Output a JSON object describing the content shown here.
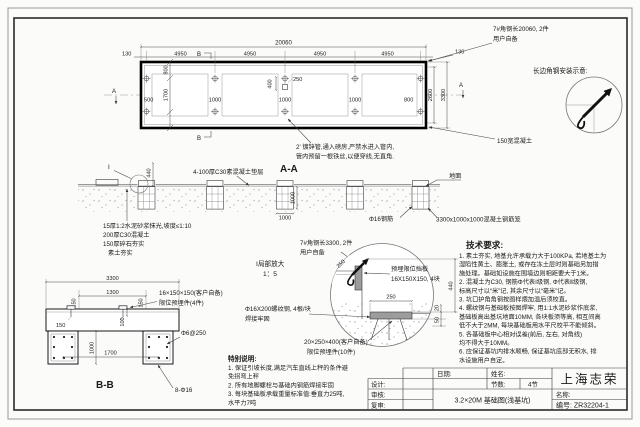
{
  "plan": {
    "dims": {
      "total": "20060",
      "seg": [
        "4950",
        "4950",
        "4950",
        "4950"
      ],
      "end_left": "130",
      "end_right": "130",
      "v800": "800",
      "v1700": "1700",
      "left_margin": "500",
      "gaps": [
        "1000",
        "1000",
        "1000"
      ],
      "right_margin": "800",
      "inner_width": "2600",
      "outer_width": "3300",
      "c250": "250",
      "c400": "400"
    },
    "marker_b_top": "B",
    "marker_b_bottom": "B",
    "marker_a_left": "A",
    "marker_a_right": "A",
    "note_pipe1": "2′ 镀锌管,通入磅房,严禁水进入管内,",
    "note_pipe2": "管内预留一根铁丝,以便穿线,无直角.",
    "angle_label1": "7#角钢长20060, 2件",
    "angle_label2": "用户自备",
    "edge_label": "150宽混凝土"
  },
  "corner": {
    "title": "长边角钢安装示意:"
  },
  "aa": {
    "title": "A-A",
    "cushion": "4-100厚C30素混凝土垫层",
    "detail_mark": "Ⅰ",
    "d440": "440",
    "d1000v": "1000",
    "d1000h": "1000",
    "ground": "地面",
    "layer1": "15厚1:2水泥砂浆抹光,坡度≤1:10",
    "layer2": "200厚C30混凝土",
    "layer3": "150厚碎石夯实",
    "layer4": "素土夯实",
    "rebar": "Φ16钢筋",
    "cage": "3300x1000x1000混凝土钢筋笼",
    "angle_label1": "7#角钢长3300, 2件",
    "angle_label2": "用户自备"
  },
  "detail": {
    "title1": "Ⅰ局部放大",
    "title2": "1：5",
    "plate1": "预埋限位挡板",
    "plate2": "16X150X150, 4块",
    "d250diag": "250",
    "d250": "250",
    "d440": "440",
    "d20": "20",
    "d50": "50",
    "bolt1": "Φ16X200螺纹钢, 4根/块",
    "bolt2": "焊接牢固",
    "stop1": "20×250×400(客户自备)",
    "stop2": "限位预埋件(10件)"
  },
  "bb": {
    "title": "B-B",
    "d3300": "3300",
    "d1300": "1300",
    "d150a": "150",
    "d150b": "150",
    "d150c": "150",
    "d100": "100",
    "d1000": "1000",
    "d1700": "1700",
    "embed1": "16×150×150(客户自备)",
    "embed2": "限位预埋件(4件)",
    "stirrup": "Φ6@250",
    "rebar": "8-Φ16"
  },
  "special": {
    "title": "特别说明:",
    "lines": [
      "1. 保证引坡长度,满足汽车直线上秤的条件避",
      "免拐弯上秤",
      "2. 所有地脚螺栓与基础内钢筋焊接牢固",
      "3. 每块基础板承载重量标准值:垂直力25吨,",
      "水平力7吨"
    ]
  },
  "tech": {
    "title": "技术要求:",
    "lines": [
      "1. 素土夯实, 地基允许承载力大于100KPa, 若地基土为",
      "湿陷性黄土、膨胀土, 或存在冻土层时则基础另加措",
      "施处理。基础如设施在围墙边则相距要大于1米。",
      "2. 混凝土为C30, 钢筋Φ代表Ⅰ级钢, Φ代表Ⅱ级钢,",
      "标高尺寸以“米”记, 其余尺寸以“毫米”记。",
      "3. 坑口护角角钢按图样煨加温后须校直。",
      "4. 螺纹钢与基础板按图焊牢, 用1:1水泥砂浆作底浆,",
      "基础板高出基坑地面10MM, 各块板须等高, 相互间高",
      "低不大于2MM, 每块基础板用水平尺校平不能倾斜。",
      "5. 各基础板中心相对误差(前后, 左右, 对角线)",
      "均不得大于10MM。",
      "6. 应保证基坑内排水顺畅, 保证基坑底部无积水, 排",
      "水设施用户自定。"
    ]
  },
  "tb": {
    "date": "日期:",
    "name": "姓名:",
    "sections": "节数:",
    "sections_val": "4节",
    "design": "设计:",
    "check": "审核:",
    "recheck": "复审:",
    "brand": "上海志荣",
    "title": "3.2×20M 基础图(浅基坑)",
    "name_label": "名称:",
    "number": "编号: ZR32204-1"
  }
}
